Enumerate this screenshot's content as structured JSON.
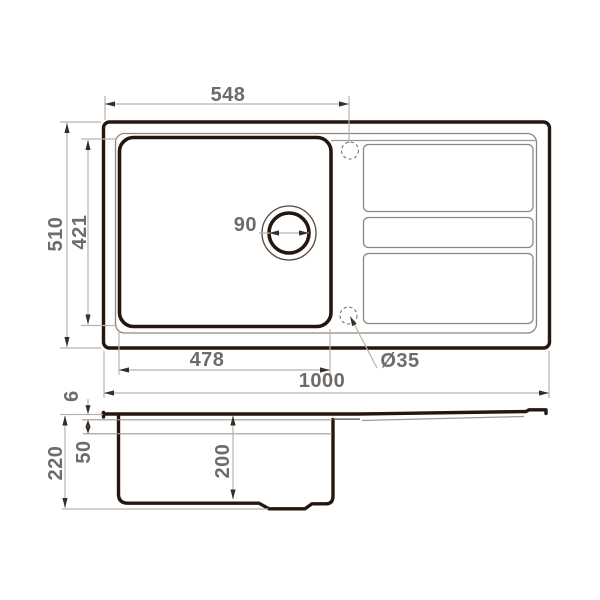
{
  "drawing": {
    "subject": "kitchen sink technical dimension drawing",
    "views": {
      "top_view": "plan view with bowl, drain and drainboard",
      "side_view": "section profile"
    },
    "units": "mm",
    "colors": {
      "outline_dark": "#251710",
      "dimension_line": "#b7b3b0",
      "dimension_text": "#6f6b68",
      "arrowhead": "#3a2d24",
      "background": "#ffffff"
    }
  },
  "dims": {
    "top_offset": "548",
    "overall_depth": "510",
    "bowl_depth": "421",
    "drain_diameter": "90",
    "bowl_width": "478",
    "overall_width": "1000",
    "tap_hole": "Ø35",
    "rim_height": "6",
    "ledge_depth": "50",
    "section_height": "220",
    "bowl_inner_depth": "200"
  }
}
